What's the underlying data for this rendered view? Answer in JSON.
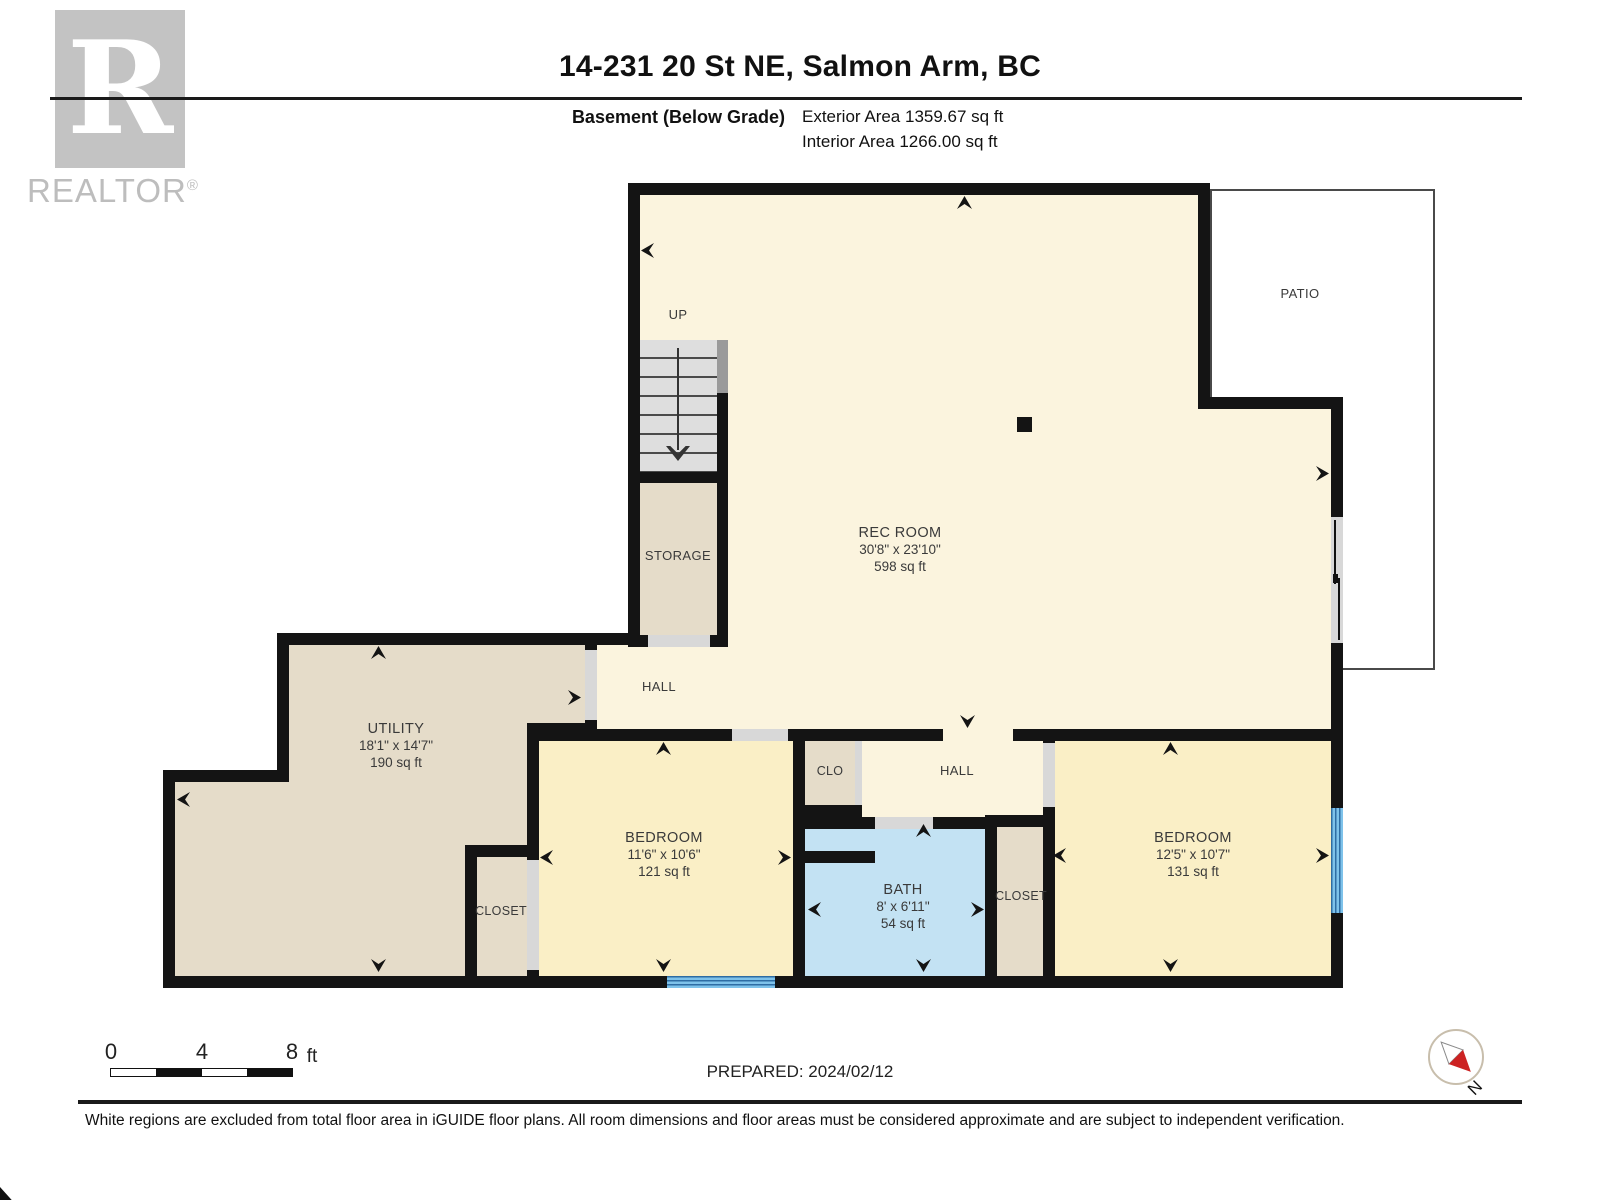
{
  "header": {
    "title": "14-231 20 St NE, Salmon Arm, BC",
    "floor_label": "Basement (Below Grade)",
    "exterior_area": "Exterior Area 1359.67 sq ft",
    "interior_area": "Interior Area 1266.00 sq ft",
    "logo_text": "REALTOR",
    "logo_mark": "®",
    "logo_letter": "R"
  },
  "rooms": {
    "rec_room": {
      "name": "REC ROOM",
      "dims": "30'8\" x 23'10\"",
      "area": "598 sq ft"
    },
    "utility": {
      "name": "UTILITY",
      "dims": "18'1\" x 14'7\"",
      "area": "190 sq ft"
    },
    "bedroom_left": {
      "name": "BEDROOM",
      "dims": "11'6\" x 10'6\"",
      "area": "121 sq ft"
    },
    "bedroom_right": {
      "name": "BEDROOM",
      "dims": "12'5\" x 10'7\"",
      "area": "131 sq ft"
    },
    "bath": {
      "name": "BATH",
      "dims": "8' x 6'11\"",
      "area": "54 sq ft"
    },
    "storage": {
      "name": "STORAGE"
    },
    "hall_upper": {
      "name": "HALL"
    },
    "hall_lower": {
      "name": "HALL"
    },
    "clo": {
      "name": "CLO"
    },
    "closet_left": {
      "name": "CLOSET"
    },
    "closet_right": {
      "name": "CLOSET"
    },
    "patio": {
      "name": "PATIO"
    },
    "stairs": {
      "label": "UP"
    }
  },
  "scale_bar": {
    "tick0": "0",
    "tick1": "4",
    "tick2": "8",
    "unit": "ft"
  },
  "footer": {
    "prepared": "PREPARED: 2024/02/12",
    "disclaimer": "White regions are excluded from total floor area in iGUIDE floor plans. All room dimensions and floor areas must be considered approximate and are subject to independent verification.",
    "compass_label": "N"
  },
  "colors": {
    "wall": "#141414",
    "living_area": "#FBF4DE",
    "bedroom": "#FAEFC6",
    "utility_storage": "#E5DCC9",
    "bath": "#C3E2F3",
    "window": "#7EC2EA",
    "window_stripe": "#2E6DA4",
    "door_opening": "#D8D8D8",
    "stairs": "#DEDEDE",
    "compass_needle_red": "#CC2222",
    "compass_face": "#ADD6F2",
    "logo_gray": "#C3C3C3"
  }
}
